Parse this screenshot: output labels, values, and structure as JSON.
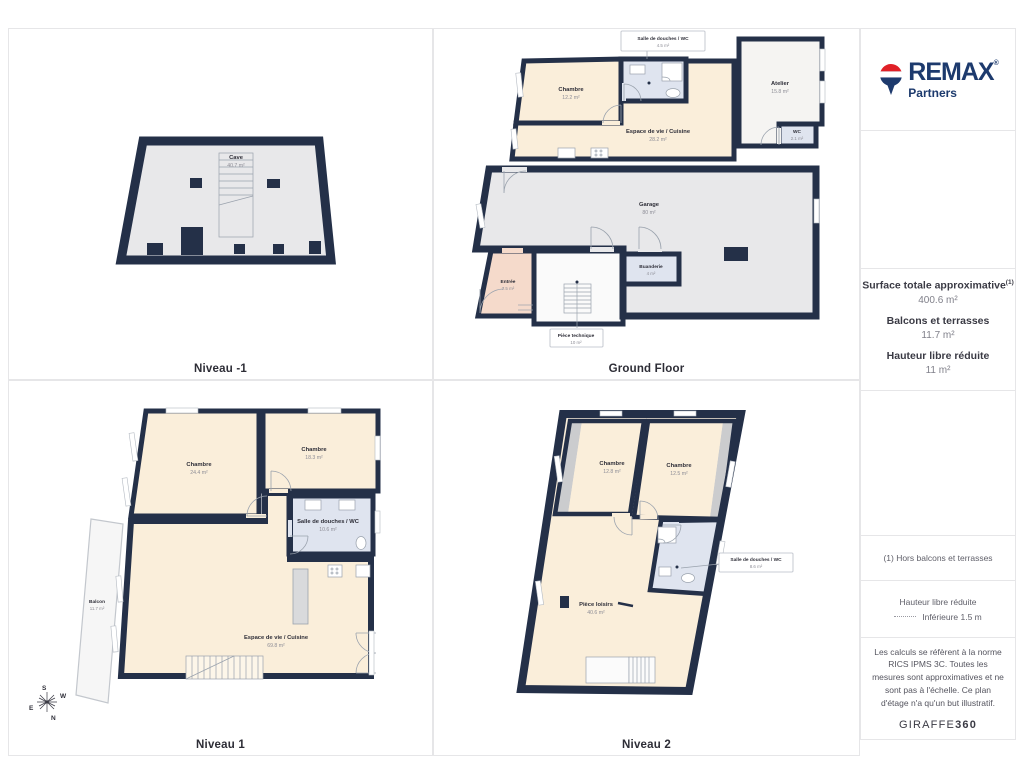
{
  "panels": [
    {
      "id": "niveau-minus-1",
      "title": "Niveau -1",
      "rooms": [
        {
          "name": "Cave",
          "area": "40.7 m²"
        }
      ]
    },
    {
      "id": "ground-floor",
      "title": "Ground Floor",
      "rooms": [
        {
          "name": "Salle de douches / WC",
          "area": "4.5 m²"
        },
        {
          "name": "Chambre",
          "area": "12.2 m²"
        },
        {
          "name": "Espace de vie / Cuisine",
          "area": "28.2 m²"
        },
        {
          "name": "Atelier",
          "area": "15.8 m²"
        },
        {
          "name": "WC",
          "area": "2.1 m²"
        },
        {
          "name": "Garage",
          "area": "80 m²"
        },
        {
          "name": "Entrée",
          "area": "7.5 m²"
        },
        {
          "name": "Buanderie",
          "area": "4 m²"
        },
        {
          "name": "Pièce technique",
          "area": "10 m²"
        }
      ]
    },
    {
      "id": "niveau-1",
      "title": "Niveau 1",
      "rooms": [
        {
          "name": "Chambre",
          "area": "24.4 m²"
        },
        {
          "name": "Chambre",
          "area": "18.3 m²"
        },
        {
          "name": "Salle de douches / WC",
          "area": "10.6 m²"
        },
        {
          "name": "Espace de vie / Cuisine",
          "area": "69.8 m²"
        },
        {
          "name": "Balcon",
          "area": "11.7 m²"
        }
      ]
    },
    {
      "id": "niveau-2",
      "title": "Niveau 2",
      "rooms": [
        {
          "name": "Chambre",
          "area": "12.8 m²"
        },
        {
          "name": "Chambre",
          "area": "12.5 m²"
        },
        {
          "name": "Salle de douches / WC",
          "area": "8.6 m²"
        },
        {
          "name": "Pièce loisirs",
          "area": "40.6 m²"
        }
      ]
    }
  ],
  "compass": {
    "n": "N",
    "s": "S",
    "e": "E",
    "w": "W"
  },
  "sidebar": {
    "brand": {
      "name": "REMAX",
      "mark": "®",
      "sub": "Partners"
    },
    "stats": [
      {
        "label": "Surface totale approximative",
        "sup": "(1)",
        "value": "400.6 m²"
      },
      {
        "label": "Balcons et terrasses",
        "value": "11.7 m²"
      },
      {
        "label": "Hauteur libre réduite",
        "value": "11 m²"
      }
    ],
    "footnote": "(1) Hors balcons et terrasses",
    "legend": {
      "title": "Hauteur libre réduite",
      "value": "Inférieure 1.5 m"
    },
    "disclaimer": "Les calculs se réfèrent à la norme RICS IPMS 3C. Toutes les mesures sont approximatives et ne sont pas à l'échelle. Ce plan d'étage n'a qu'un but illustratif.",
    "watermark": {
      "normal": "GIRAFFE",
      "bold": "360"
    }
  },
  "colors": {
    "wall": "#243048",
    "floor_gray": "#e8e8ea",
    "floor_beige": "#faeeda",
    "floor_blue": "#dfe4ef",
    "floor_pink": "#f5dacb",
    "floor_white": "#f5f4f2",
    "slope_gray": "#cbccce",
    "remax_navy": "#1d3a6d",
    "remax_red": "#e02027"
  }
}
